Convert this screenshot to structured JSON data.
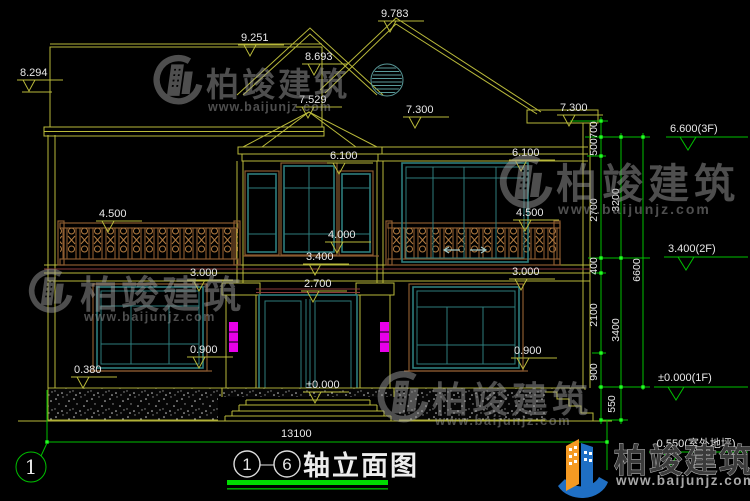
{
  "watermark": {
    "brand": "柏竣建筑",
    "url": "www.baijunjz.com"
  },
  "footer_logo": {
    "brand": "柏竣建筑",
    "url": "www.baijunjz.com"
  },
  "title_block": {
    "axis_from": "1",
    "separator": "—",
    "axis_to": "6",
    "name": "轴立面图"
  },
  "axis_bubbles": {
    "left": "1"
  },
  "dimensions": {
    "top": {
      "d9783": "9.783",
      "d9251": "9.251",
      "d8693": "8.693",
      "d8294": "8.294",
      "d7529": "7.529",
      "d7300_left": "7.300",
      "d7300_right": "7.300"
    },
    "mid": {
      "d6100_center": "6.100",
      "d6100_right": "6.100",
      "d4500_left": "4.500",
      "d4500_right": "4.500",
      "d4000": "4.000",
      "d3400": "3.400",
      "d3000_left": "3.000",
      "d3000_right": "3.000",
      "d2700": "2.700",
      "dzero": "±0.000",
      "d0900_left": "0.900",
      "d0900_right": "0.900",
      "d0380": "0.380"
    },
    "overall_width": "13100",
    "right_chain": {
      "c700": "700",
      "c500": "500",
      "c2700": "2700",
      "c3200": "3200",
      "c400": "400",
      "c2100": "2100",
      "c3400": "3400",
      "c900": "900",
      "c550": "550",
      "c6600": "6600"
    },
    "elevation_marks": {
      "f3": "6.600(3F)",
      "f2": "3.400(2F)",
      "f1": "±0.000(1F)",
      "outdoor": "-0.550(室外地坪)"
    }
  },
  "colors": {
    "line_yellow": "#b9b93a",
    "line_green": "#00c000",
    "tick_green": "#22ff22",
    "window_teal": "#2e7d7d",
    "trim_brown": "#8a5a30",
    "railing_brown": "#9a6535",
    "lamp_magenta": "#e800e8",
    "watermark_gray": "#9c9c9c",
    "logo_blue": "#1f6fc4",
    "logo_orange": "#f59a23",
    "title_green": "#00dc00",
    "background": "#000000"
  }
}
